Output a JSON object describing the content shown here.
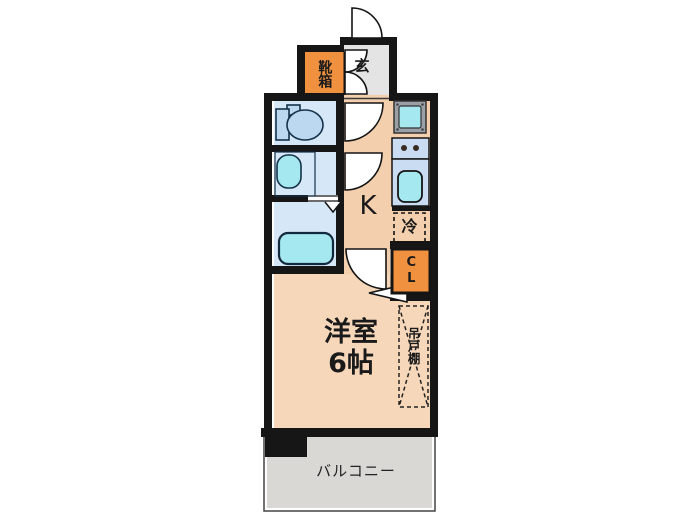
{
  "floorplan": {
    "labels": {
      "entrance": "玄",
      "shoe_cabinet": "靴箱",
      "kitchen": "K",
      "refrigerator": "冷",
      "closet": "CL",
      "western_room_name": "洋室",
      "western_room_size": "6帖",
      "hanging_cupboard": "吊戸棚",
      "balcony": "バルコニー"
    },
    "colors": {
      "wall": "#161616",
      "floor_hall": "#f3cfad",
      "floor_room": "#f6d7ba",
      "entrance_floor": "#e4e4e4",
      "storage_orange": "#f09140",
      "wet_room": "#d6e8f7",
      "fixture_blue": "#bcd7f0",
      "fixture_cyan": "#a5e8f0",
      "counter_blue": "#c9dcf2",
      "washer_pan_gray": "#9aa0a6",
      "balcony_gray": "#dad8d5",
      "burner_dot": "#3a2b22"
    }
  }
}
